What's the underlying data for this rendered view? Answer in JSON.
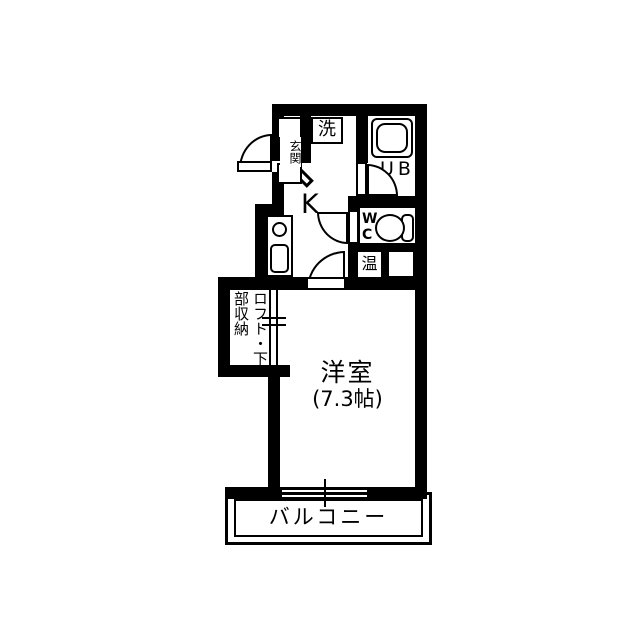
{
  "floorplan": {
    "type": "apartment-floor-plan",
    "colors": {
      "wall": "#000000",
      "background": "#ffffff",
      "floor": "#ffffff"
    },
    "rooms": {
      "entrance": {
        "label": "玄関"
      },
      "laundry": {
        "label": "洗"
      },
      "unit_bath": {
        "label": "UB"
      },
      "kitchen": {
        "label": "K"
      },
      "toilet": {
        "label_line1": "W",
        "label_line2": "C"
      },
      "water_heater": {
        "label": "温"
      },
      "loft_storage": {
        "label": "ロフト・下部収納"
      },
      "western_room": {
        "label": "洋室",
        "size": "(7.3帖)"
      },
      "balcony": {
        "label": "バルコニー"
      }
    }
  }
}
